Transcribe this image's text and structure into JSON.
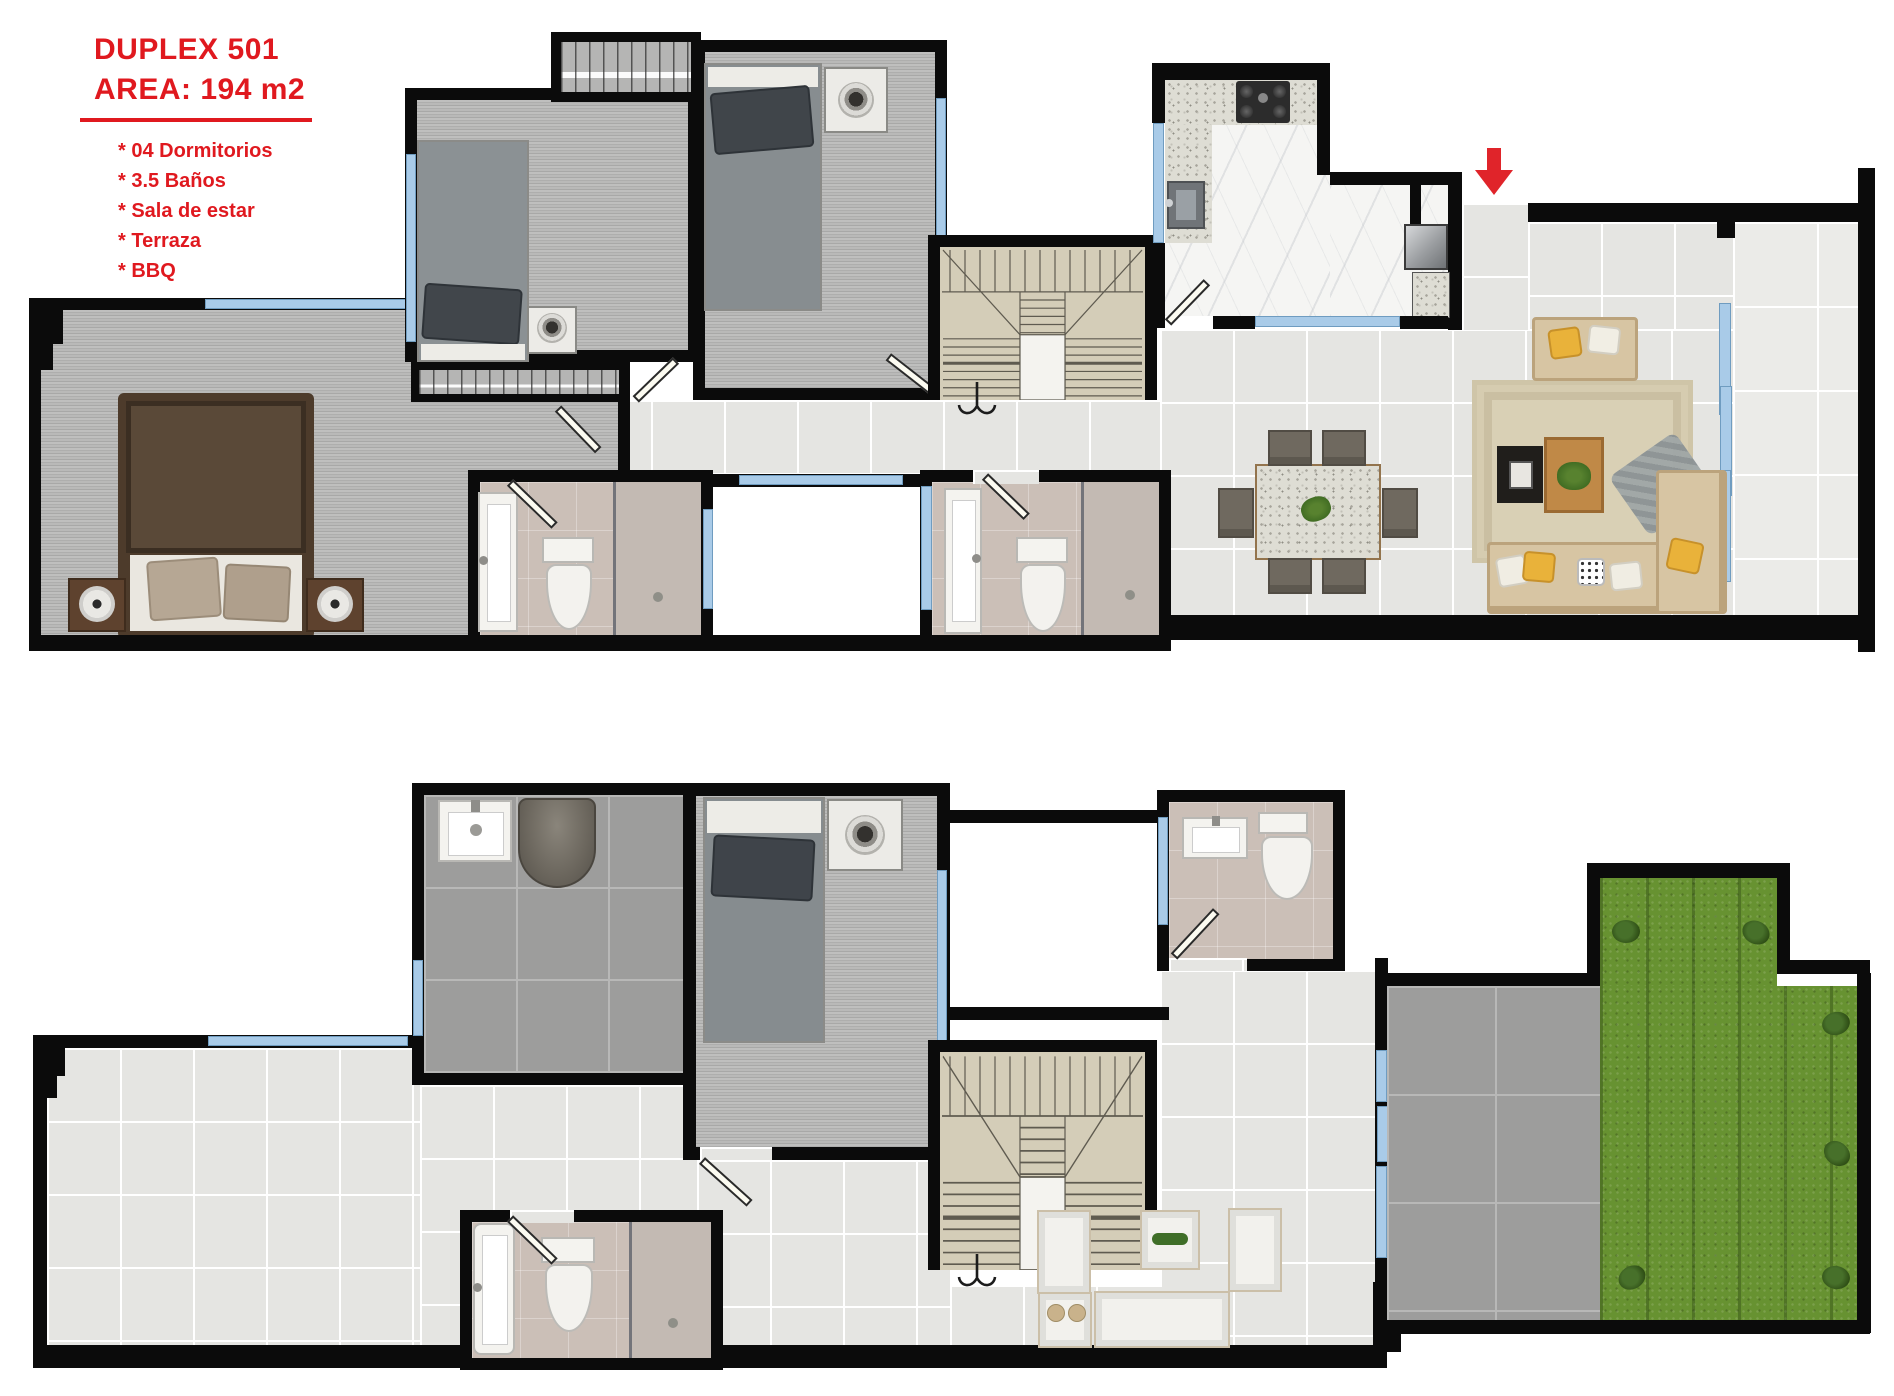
{
  "header": {
    "title": "DUPLEX 501",
    "area_label": "AREA: 194 m2",
    "features": [
      "* 04 Dormitorios",
      "* 3.5 Baños",
      "* Sala de estar",
      "* Terraza",
      "* BBQ"
    ]
  },
  "entry": {
    "arrow_icon": "entry-down-arrow-icon"
  },
  "stairs": {
    "direction_icon": "stair-down-hook-icon"
  },
  "colors": {
    "accent_red": "#e0191f",
    "wall_black": "#0b0b0b",
    "window_blue": "#a9cbe8",
    "floor_tile_light": "#e5e5e2",
    "floor_tile_dark": "#9d9d9c",
    "floor_plank_gray": "#b5b5b4",
    "stairs_beige": "#d4cdb8",
    "bathroom_floor": "#cbbfb7",
    "kitchen_marble": "#f5f5f3",
    "counter_granite": "#deddd4",
    "grass_green": "#679231",
    "sofa_beige": "#d7c5a3",
    "pillow_yellow": "#e9b23a",
    "wood_brown": "#c08947",
    "master_bed_brown": "#5a4938"
  }
}
